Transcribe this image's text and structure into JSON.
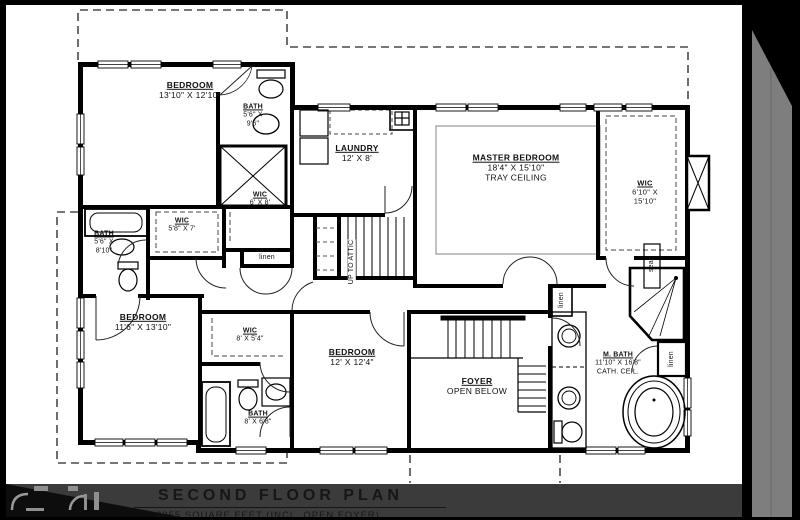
{
  "drawing": {
    "type": "architectural floor plan",
    "colors": {
      "wall": "#000000",
      "paper": "#ffffff",
      "footer_bar": "#3b3b3b",
      "page_bevel": "#7e7e7e",
      "dashed_line": "#4a4a4a"
    }
  },
  "rooms": {
    "bedroom1": {
      "name": "BEDROOM",
      "lines": [
        "13'10\" X 12'10\""
      ]
    },
    "bath1": {
      "name": "BATH",
      "lines": [
        "5'6\" X",
        "9'6\""
      ]
    },
    "wic1": {
      "name": "WIC",
      "lines": [
        "6' X 8'"
      ]
    },
    "laundry": {
      "name": "LAUNDRY",
      "lines": [
        "12' X 8'"
      ]
    },
    "master": {
      "name": "MASTER BEDROOM",
      "lines": [
        "18'4\" X 15'10\"",
        "TRAY CEILING"
      ]
    },
    "wic_master": {
      "name": "WIC",
      "lines": [
        "6'10\" X",
        "15'10\""
      ]
    },
    "bath2": {
      "name": "BATH",
      "lines": [
        "5'6\" X",
        "8'10\""
      ]
    },
    "wic2": {
      "name": "WIC",
      "lines": [
        "5'8\" X 7'"
      ]
    },
    "bedroom2": {
      "name": "BEDROOM",
      "lines": [
        "11'6\" X 13'10\""
      ]
    },
    "wic3": {
      "name": "WIC",
      "lines": [
        "8' X 5'4\""
      ]
    },
    "bedroom3": {
      "name": "BEDROOM",
      "lines": [
        "12' X 12'4\""
      ]
    },
    "bath3": {
      "name": "BATH",
      "lines": [
        "8' X 6'8\""
      ]
    },
    "foyer": {
      "name": "FOYER",
      "lines": [
        "OPEN BELOW"
      ]
    },
    "mbath": {
      "name": "M. BATH",
      "lines": [
        "11'10\" X 16'8\"",
        "CATH. CEIL."
      ]
    }
  },
  "labels": {
    "linen": "linen",
    "seat": "seat",
    "up_to_attic": "UP TO ATTIC"
  },
  "footer": {
    "title": "SECOND FLOOR PLAN",
    "subtitle": "2055 SQUARE FEET (INCL. OPEN FOYER)"
  }
}
